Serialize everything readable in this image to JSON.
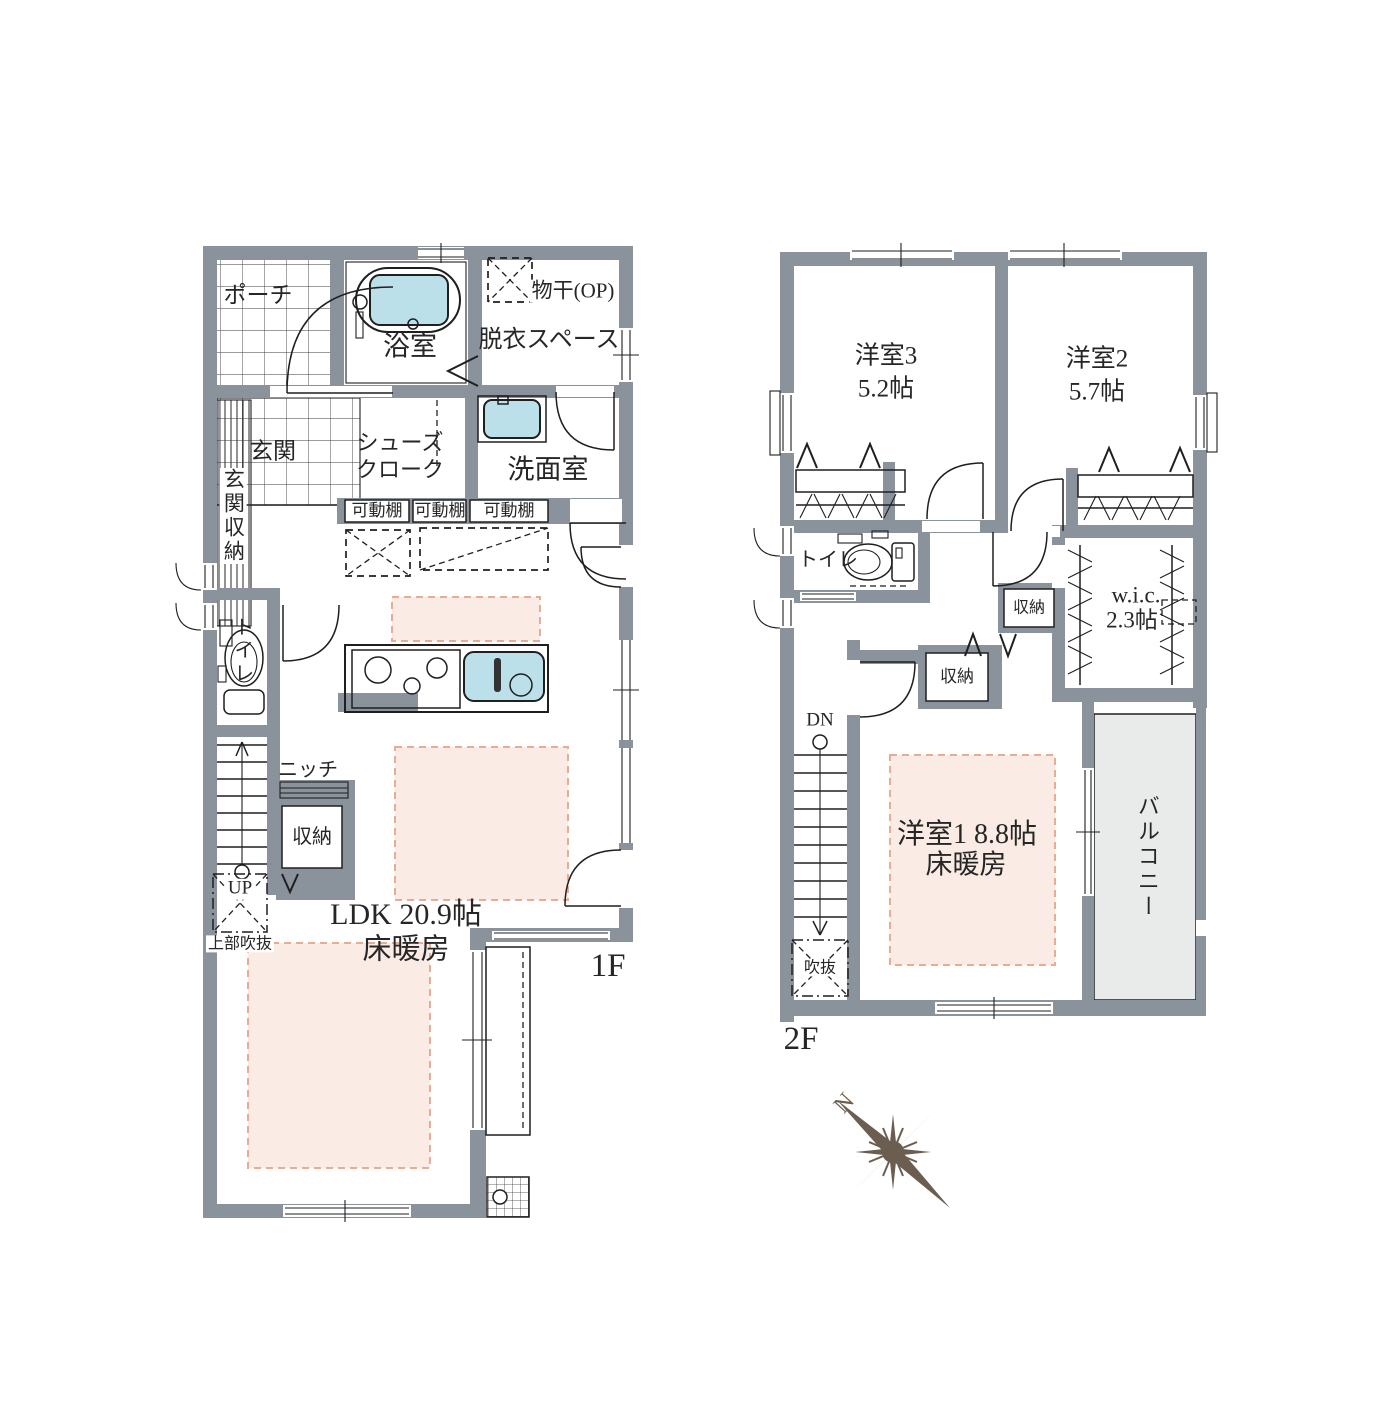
{
  "colors": {
    "wall": "#8A939B",
    "water": "#BCE0EA",
    "heat": "#FAECE4",
    "heatline": "#E7AC92",
    "balcony": "#E9EAEA",
    "compass": "#6B5E50"
  },
  "floor1": {
    "floor_label": "1F",
    "labels": {
      "porch": "ポーチ",
      "bath": "浴室",
      "drying": "物干(OP)",
      "undress": "脱衣スペース",
      "entrance": "玄関",
      "entrance_storage": "玄関収納",
      "shoe_cloak_1": "シューズ",
      "shoe_cloak_2": "クローク",
      "washroom": "洗面室",
      "shelf1": "可動棚",
      "shelf2": "可動棚",
      "shelf3": "可動棚",
      "toilet": "トイレ",
      "niche": "ニッチ",
      "storage": "収納",
      "up": "UP",
      "void_above": "上部吹抜",
      "ldk": "LDK 20.9帖",
      "ldk_heating": "床暖房"
    }
  },
  "floor2": {
    "floor_label": "2F",
    "labels": {
      "room3": "洋室3",
      "room3_size": "5.2帖",
      "room2": "洋室2",
      "room2_size": "5.7帖",
      "toilet": "トイレ",
      "storage_top": "収納",
      "storage_mid": "収納",
      "wic": "w.i.c.",
      "wic_size": "2.3帖",
      "dn": "DN",
      "void": "吹抜",
      "room1": "洋室1  8.8帖",
      "room1_heating": "床暖房",
      "balcony": "バルコニー"
    }
  },
  "compass": {
    "north": "N"
  }
}
